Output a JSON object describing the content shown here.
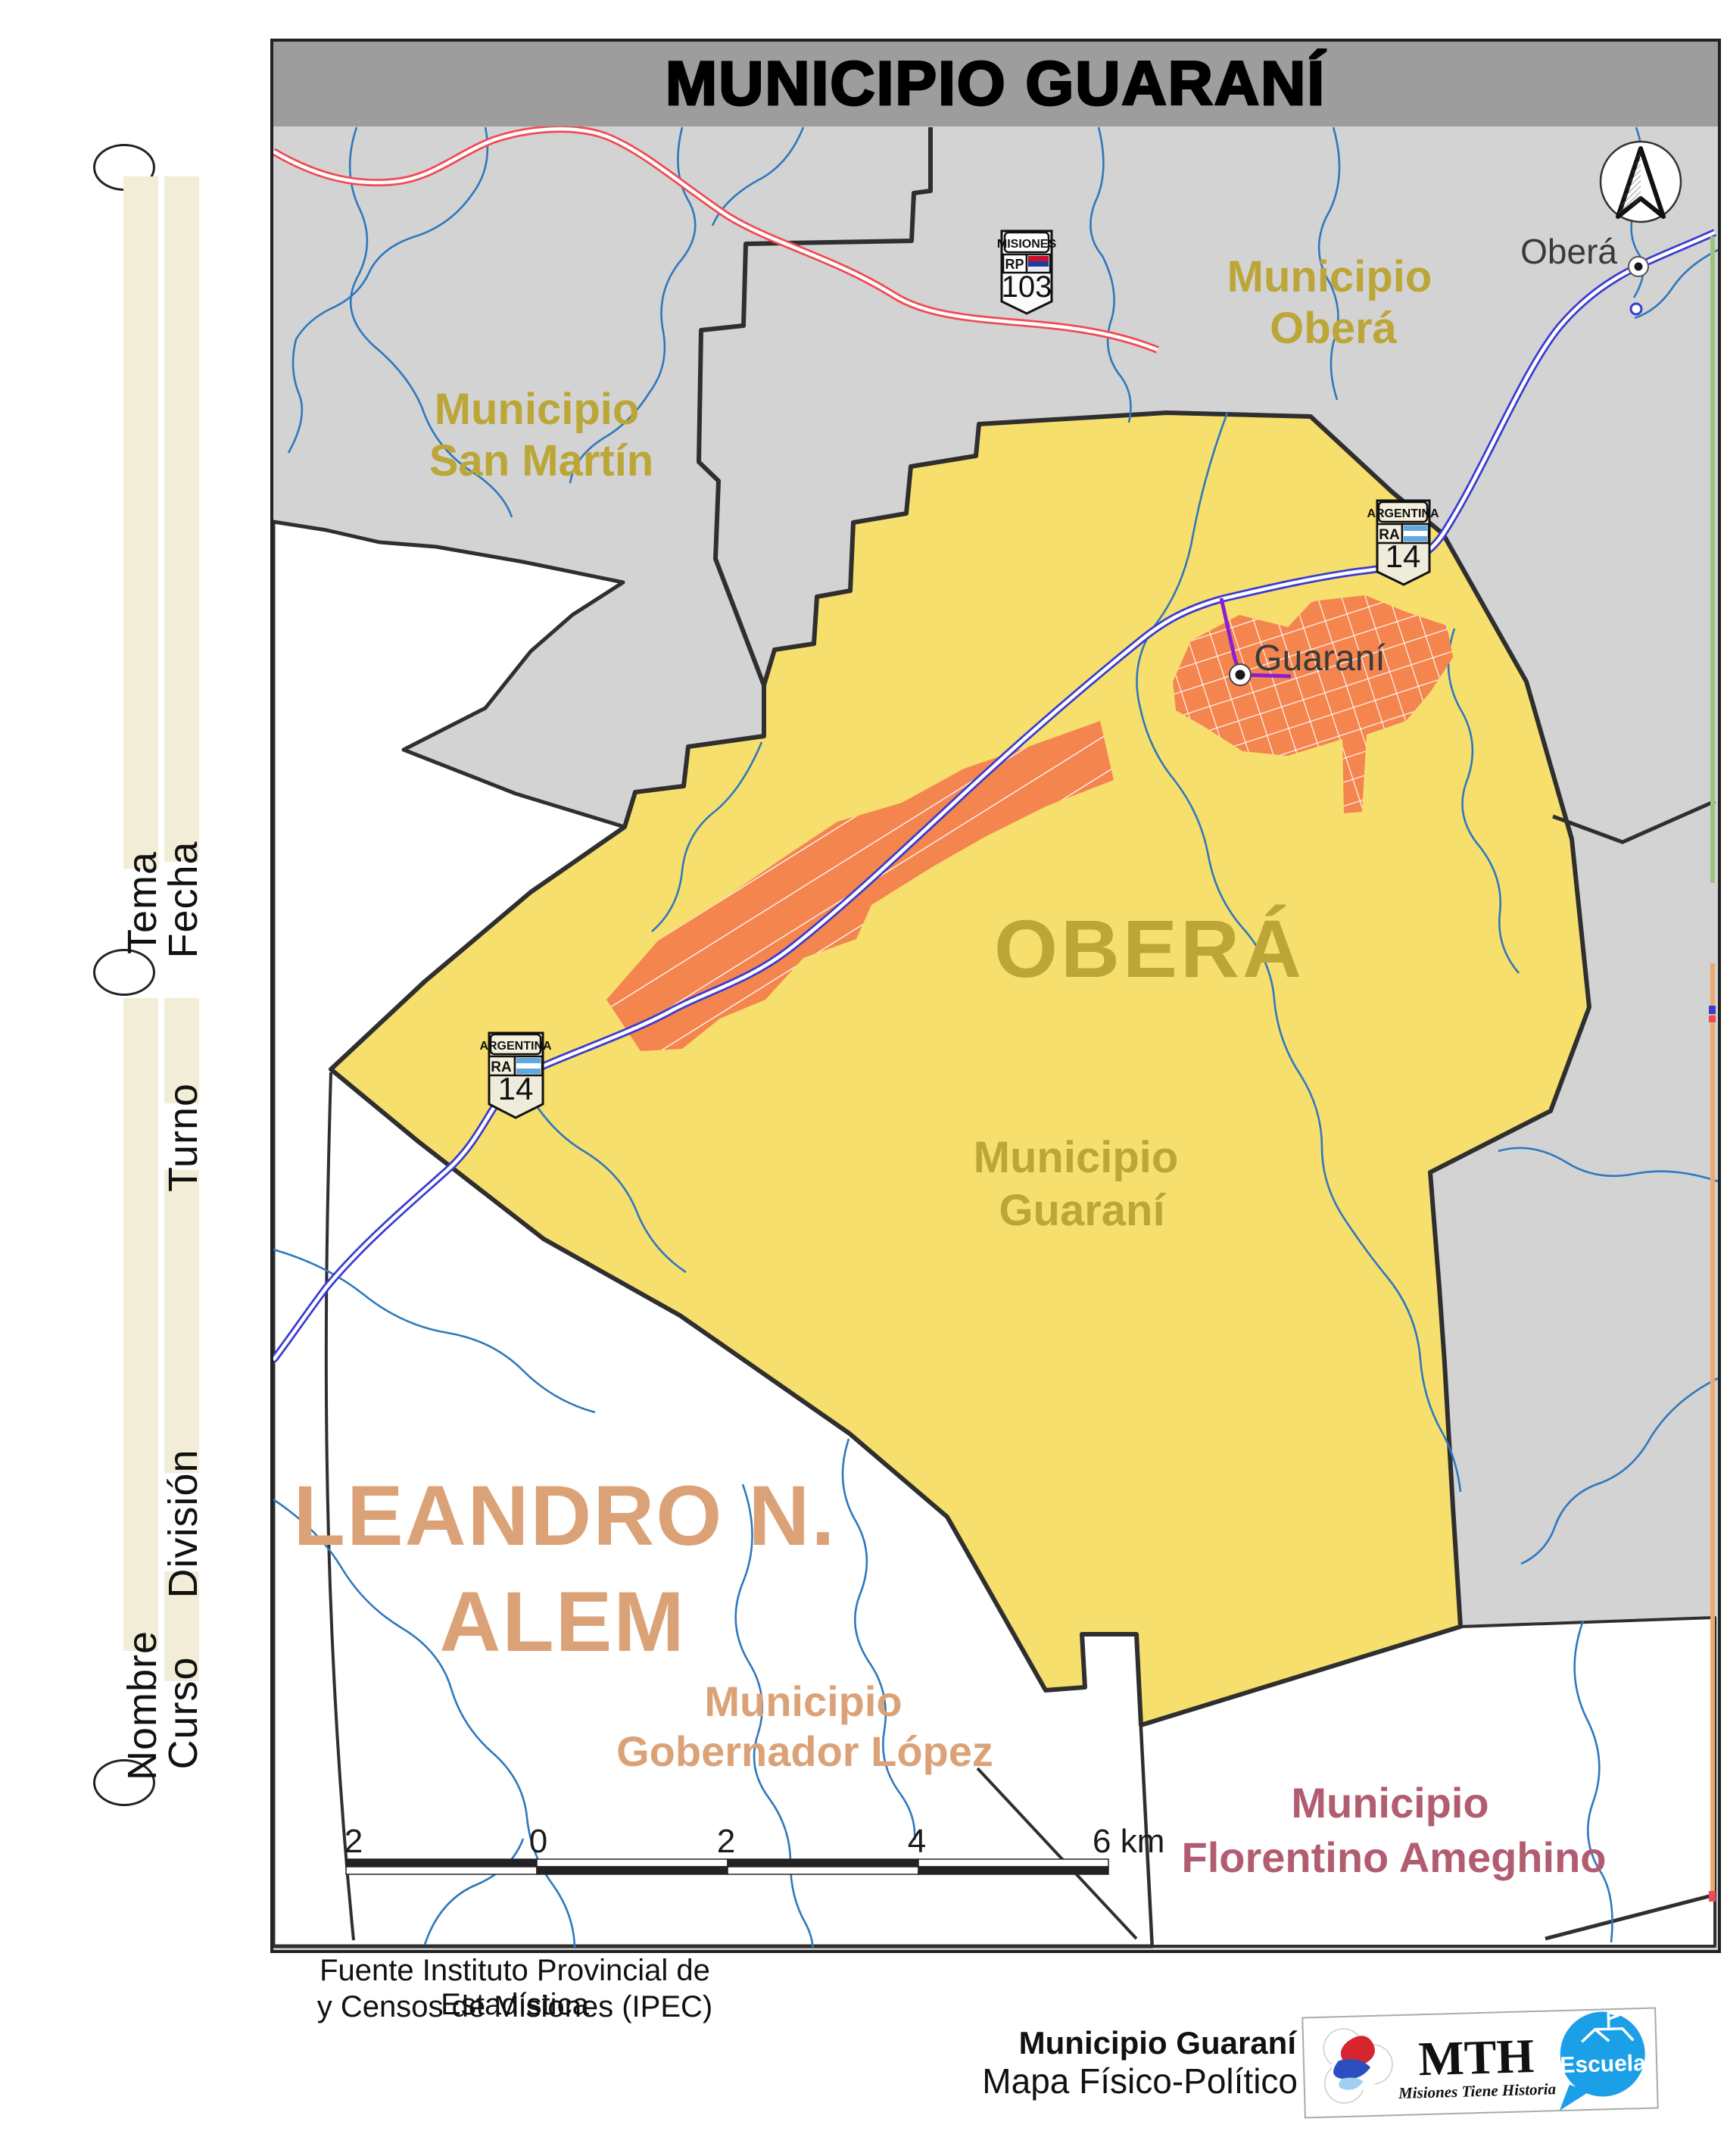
{
  "title": {
    "text": "MUNICIPIO GUARANÍ"
  },
  "margin": {
    "tema": "Tema",
    "fecha": "Fecha",
    "turno": "Turno",
    "division": "División",
    "nombre": "Nombre",
    "curso": "Curso"
  },
  "map": {
    "region_labels": {
      "san_martin_line1": "Municipio",
      "san_martin_line2": "San Martín",
      "obera_mun_line1": "Municipio",
      "obera_mun_line2": "Oberá",
      "obera_dept": "OBERÁ",
      "guarani_mun_line1": "Municipio",
      "guarani_mun_line2": "Guaraní",
      "alem_line1": "LEANDRO N.",
      "alem_line2": "ALEM",
      "gob_lopez_line1": "Municipio",
      "gob_lopez_line2": "Gobernador López",
      "florentino_line1": "Municipio",
      "florentino_line2": "Florentino Ameghino"
    },
    "city_labels": {
      "obera": "Oberá",
      "guarani": "Guaraní"
    },
    "shields": {
      "rp103": {
        "region": "MISIONES",
        "prefix": "RP",
        "number": "103"
      },
      "ra14": {
        "country": "ARGENTINA",
        "prefix": "RA",
        "number": "14"
      }
    },
    "scale_bar": {
      "t0": "2",
      "t1": "0",
      "t2": "2",
      "t3": "4",
      "t4": "6 km"
    },
    "colors": {
      "municipality_fill": "#F7DF6D",
      "urban_fill": "#F5854F",
      "neighbor_fill": "#D3D3D3",
      "river": "#2E78BE",
      "route_ra14": "#3B3BD1",
      "route_rp103": "#F04B55",
      "access_road": "#8A1FD0",
      "dept_label": "#BCA637",
      "alem_label": "#DCA277",
      "florentino_label": "#B25C70"
    }
  },
  "footer": {
    "source_line1": "Fuente Instituto Provincial de Estadística",
    "source_line2": "y Censos de Misiones (IPEC)",
    "credit_line1": "Municipio Guaraní",
    "credit_line2": "Mapa Físico-Político",
    "mth": "MTH",
    "mth_tagline": "Misiones Tiene Historia",
    "escuela": "Escuela"
  }
}
